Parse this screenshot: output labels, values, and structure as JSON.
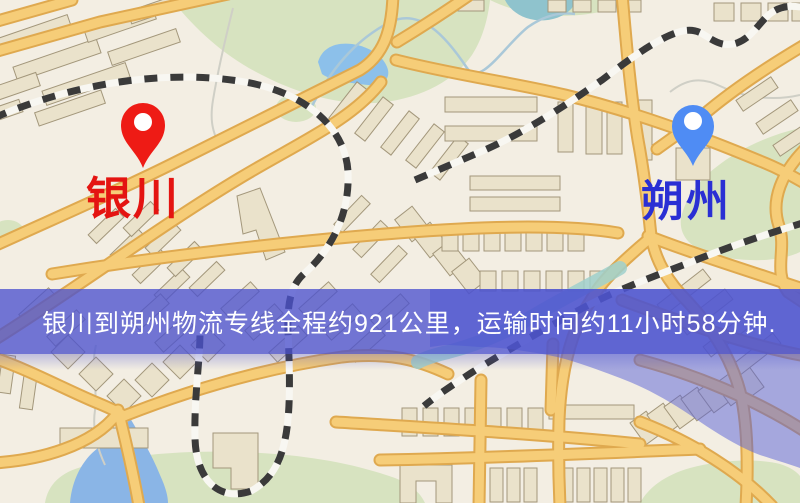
{
  "banner": {
    "text": "银川到朔州物流专线全程约921公里，运输时间约11小时58分钟.",
    "distance_text": "921公里",
    "duration_text": "11小时58分钟",
    "background_color": "#4c52ce",
    "text_color": "#ffffff"
  },
  "origin": {
    "label": "银川",
    "label_color": "#e41411",
    "marker_color": "#ee1b15",
    "marker_icon": "red-map-pin"
  },
  "destination": {
    "label": "朔州",
    "label_color": "#2a2fd4",
    "marker_color": "#4f8cf4",
    "marker_icon": "blue-map-pin"
  },
  "map": {
    "palette": {
      "background": "#f3eee3",
      "road": "#f6cd78",
      "road_casing": "#dfa94f",
      "park": "#d7e3c0",
      "water": "#8cc0ea",
      "building": "#eae2cb",
      "railway": "#3a3a3a",
      "water_overlay": "#585fd7"
    }
  }
}
